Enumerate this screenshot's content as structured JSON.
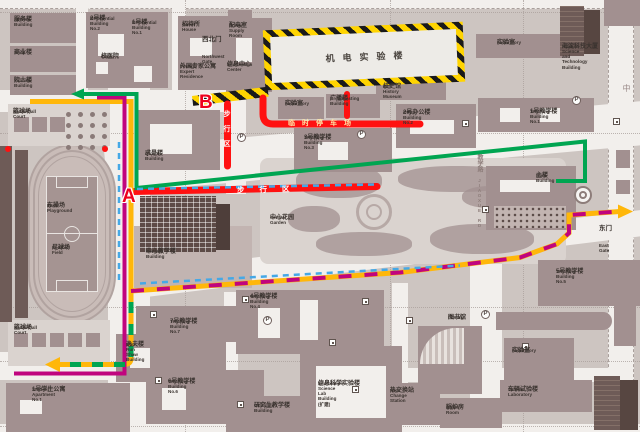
{
  "map_type": "campus-map",
  "colors": {
    "ground": "#cdc5c1",
    "road": "#f2efec",
    "building": "#a29090",
    "building_light": "#c2b4b1",
    "building_dark": "#6e5b57",
    "pale": "#dad3cf",
    "grid": "#a99f9b",
    "label": "#3a332f",
    "route_green": "#00a551",
    "route_yellow": "#ffb70a",
    "route_magenta": "#c0047e",
    "route_blue": "#45a8e6",
    "pedestrian_red": "#ff1111",
    "hazard_yellow": "#ffd400",
    "hazard_black": "#1a1a1a",
    "red_marker": "#ee001d"
  },
  "gates": [
    {
      "zh": "西北门",
      "en": "Northwest Gate"
    },
    {
      "zh": "东门",
      "en": "East Gate"
    }
  ],
  "markers": [
    {
      "text": "A"
    },
    {
      "text": "B"
    }
  ],
  "road_labels": [
    {
      "text": "步行区"
    },
    {
      "text": "步行区"
    },
    {
      "text": "临时停车场"
    },
    {
      "zh": "教学路",
      "en": "JIAOXUE RD"
    },
    {
      "text": "中"
    }
  ],
  "icons": {
    "parking": "P"
  },
  "labels": [
    {
      "zh": "服务楼",
      "en": "Service Building"
    },
    {
      "zh": "商业楼",
      "en": "Shop"
    },
    {
      "zh": "院士楼",
      "en": "Yuanshi Building"
    },
    {
      "zh": "2号楼",
      "en": "Residential\nBuilding No.2"
    },
    {
      "zh": "1号楼",
      "en": "Residential\nBuilding No.1"
    },
    {
      "zh": "校医院",
      "en": "Clinic"
    },
    {
      "zh": "招待所",
      "en": "Guest House"
    },
    {
      "zh": "外国专家公寓",
      "en": "Foreign Expert\nResidence"
    },
    {
      "zh": "配电室",
      "en": "Power Supply\nRoom"
    },
    {
      "zh": "信息中心",
      "en": "Information Center"
    },
    {
      "zh": "篮球场",
      "en": "Basketball Court"
    },
    {
      "zh": "东操场",
      "en": "East Playground"
    },
    {
      "zh": "足球场",
      "en": "Football Field"
    },
    {
      "zh": "篮球场",
      "en": "Basketball Court"
    },
    {
      "zh": "1号学生公寓",
      "en": "Student Apartment No.1"
    },
    {
      "zh": "机电实验楼",
      "en": ""
    },
    {
      "zh": "实验室",
      "en": "Laboratory"
    },
    {
      "zh": "广播楼",
      "en": "Broadcasting Building"
    },
    {
      "zh": "校史馆",
      "en": "BIT History Museum"
    },
    {
      "zh": "3号教学楼",
      "en": "Teaching Building No.3"
    },
    {
      "zh": "求是楼",
      "en": "Qiushi Building"
    },
    {
      "zh": "2号办公楼",
      "en": "Office Building No.2"
    },
    {
      "zh": "1号教学楼",
      "en": "Teaching Building No.1"
    },
    {
      "zh": "实验室",
      "en": "Laboratory"
    },
    {
      "zh": "海淀科技大厦",
      "en": "Haidian Science and\nTechnology Building"
    },
    {
      "zh": "中心教学楼",
      "en": "Central Building"
    },
    {
      "zh": "中心花园",
      "en": "Central Garden"
    },
    {
      "zh": "主楼",
      "en": "Main\nBuilding"
    },
    {
      "zh": "7号教学楼",
      "en": "Teaching Building No.7"
    },
    {
      "zh": "逸夫楼",
      "en": "Run Run Shaw Building"
    },
    {
      "zh": "4号教学楼",
      "en": "Teaching Building No.4"
    },
    {
      "zh": "6号教学楼",
      "en": "Teaching Building No.6"
    },
    {
      "zh": "研究生教学楼",
      "en": "Graduate Building"
    },
    {
      "zh": "信息科学实验楼",
      "en": "Information Science Lab\nBuilding\n(扩建)"
    },
    {
      "zh": "图书馆",
      "en": "Library"
    },
    {
      "zh": "5号教学楼",
      "en": "Teaching Building No.5"
    },
    {
      "zh": "实验室",
      "en": "Laboratory"
    },
    {
      "zh": "车辆试验楼",
      "en": "Vehicle Laboratory"
    },
    {
      "zh": "热交换站",
      "en": "Heat Change\nStation"
    },
    {
      "zh": "锅炉房",
      "en": "Boiler Room"
    }
  ]
}
